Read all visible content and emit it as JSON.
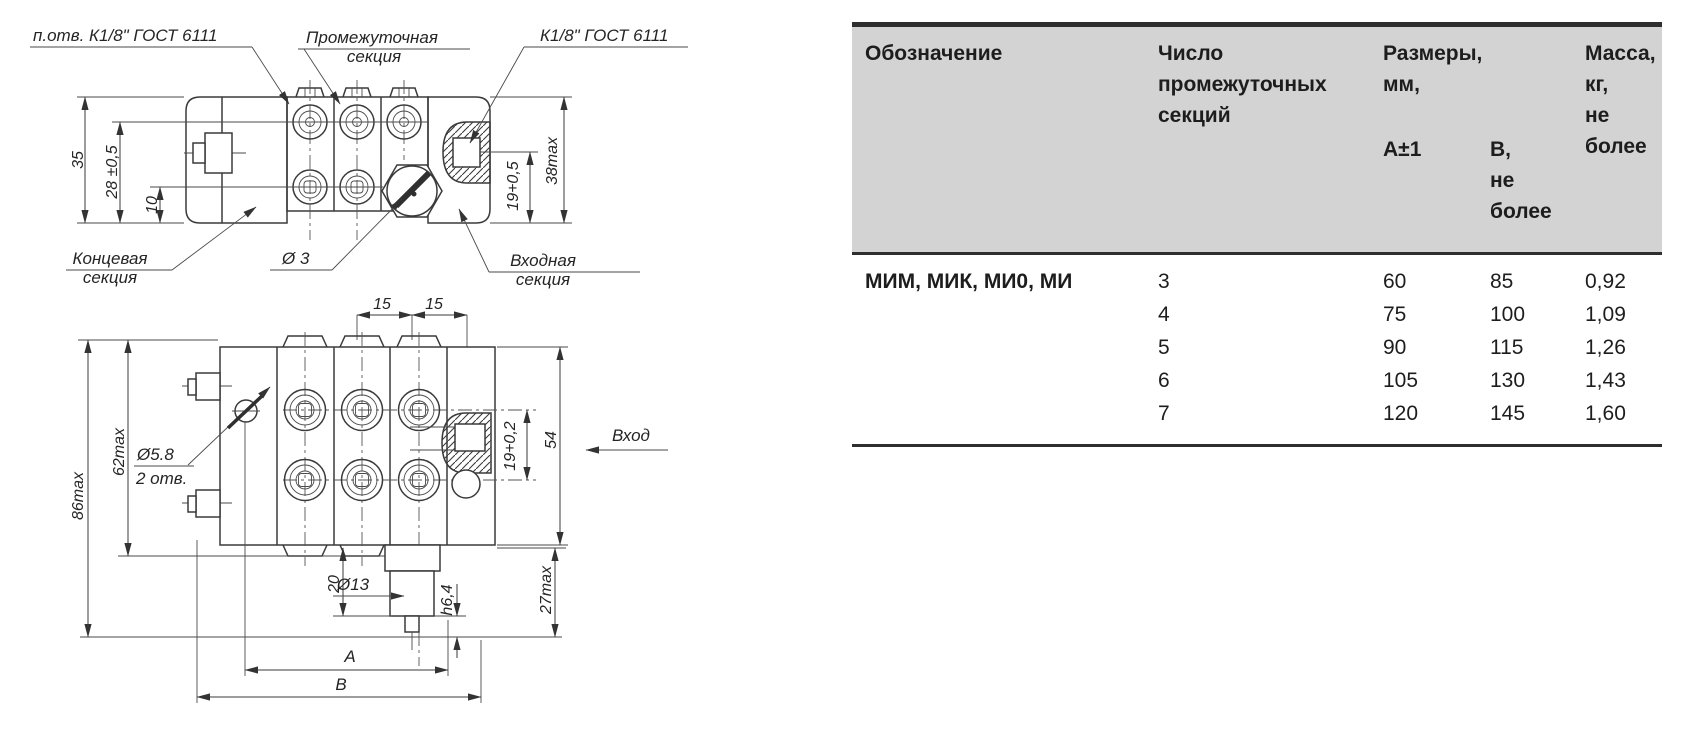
{
  "drawing": {
    "top_view": {
      "label_ports": "п.отв. К1/8\" ГОСТ 6111",
      "label_intermediate_1": "Промежуточная",
      "label_intermediate_2": "секция",
      "label_inlet_thread": "К1/8\" ГОСТ 6111",
      "label_end_1": "Концевая",
      "label_end_2": "секция",
      "label_diameter3": "Ø 3",
      "label_input_1": "Входная",
      "label_input_2": "секция",
      "dim_35": "35",
      "dim_28": "28 ±0,5",
      "dim_10": "10",
      "dim_19": "19+0,5",
      "dim_38": "38max"
    },
    "bottom_view": {
      "dim_15_left": "15",
      "dim_15_right": "15",
      "dim_62": "62max",
      "dim_86": "86max",
      "label_hole_d": "Ø5.8",
      "label_hole_n": "2 отв.",
      "dim_19": "19+0,2",
      "dim_54": "54",
      "label_inlet": "Вход",
      "dim_20": "20",
      "label_d13": "Ø13",
      "dim_64": "h6,4",
      "dim_27": "27max",
      "dim_A": "A",
      "dim_B": "B"
    }
  },
  "table": {
    "col_designation": "Обозначение",
    "col_sections": "Число\nпромежуточных\nсекций",
    "col_dimensions": "Размеры,\nмм,",
    "col_a": "А±1",
    "col_b": "В,\nне\nболее",
    "col_mass": "Масса,\nкг,\nне\nболее",
    "designation": "МИМ, МИК, МИ0, МИ",
    "rows": [
      {
        "n": "3",
        "a": "60",
        "b": "85",
        "m": "0,92"
      },
      {
        "n": "4",
        "a": "75",
        "b": "100",
        "m": "1,09"
      },
      {
        "n": "5",
        "a": "90",
        "b": "115",
        "m": "1,26"
      },
      {
        "n": "6",
        "a": "105",
        "b": "130",
        "m": "1,43"
      },
      {
        "n": "7",
        "a": "120",
        "b": "145",
        "m": "1,60"
      }
    ]
  },
  "colors": {
    "line": "#3a3a3a",
    "table_header_bg": "#d3d3d3",
    "border_dark": "#2e2e2e"
  }
}
